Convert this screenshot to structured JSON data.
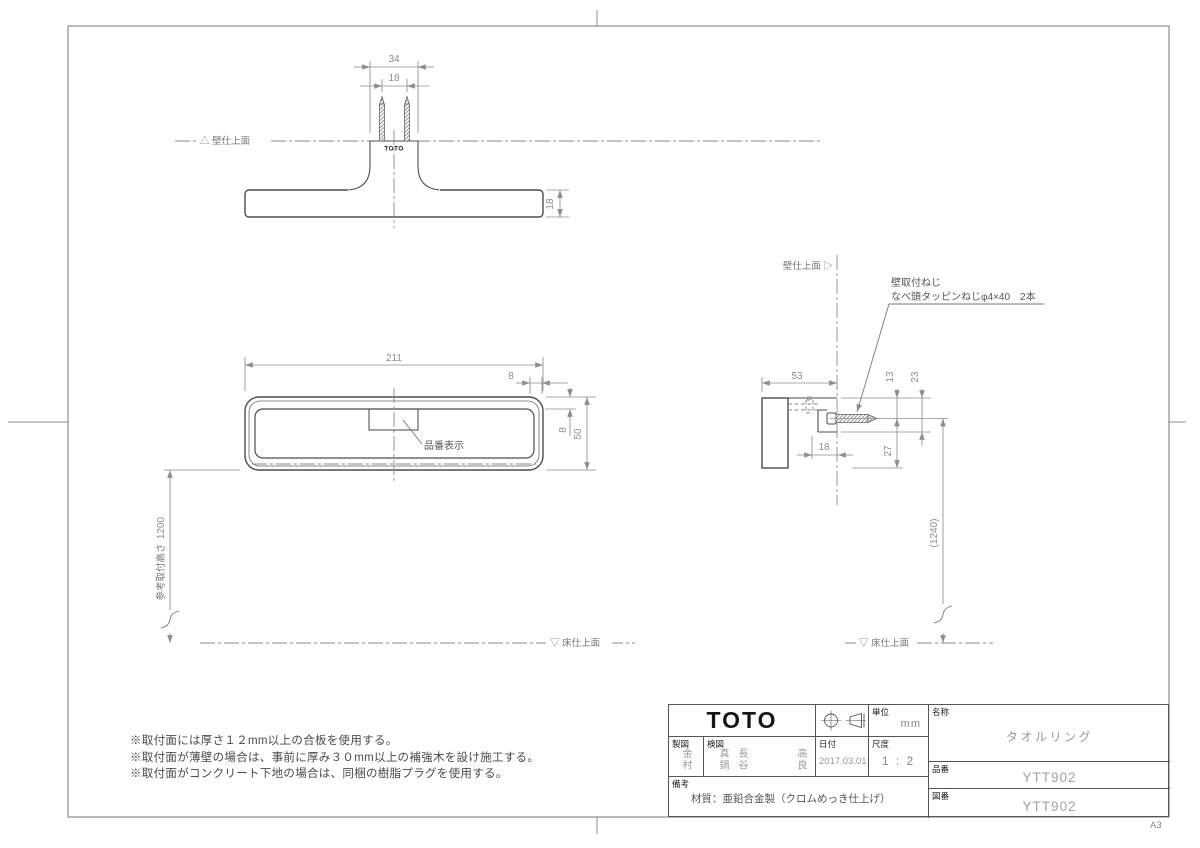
{
  "sheet": {
    "size": "A3"
  },
  "brand": {
    "logo": "TOTO",
    "part_logo": "TOTO"
  },
  "top_view": {
    "dim_mount_width": "34",
    "dim_screw_pitch": "18",
    "dim_bar_thickness": "18",
    "wall_line_label": "△ 壁仕上面"
  },
  "front_view": {
    "dim_overall_width": "211",
    "dim_rim_width": "8",
    "dim_rim_height": "8",
    "dim_overall_height": "50",
    "dim_mounting_height": "1200",
    "mounting_height_label": "参考取付高さ",
    "part_number_label": "品番表示",
    "floor_line_label": "▽ 床仕上面"
  },
  "side_view": {
    "wall_line_label": "壁仕上面 ▷",
    "screw_note_line1": "壁取付ねじ",
    "screw_note_line2": "なべ頭タッピンねじφ4×40　2本",
    "dim_depth": "53",
    "dim_screw_offset": "13",
    "dim_bracket_depth": "23",
    "dim_step": "18",
    "dim_lower": "27",
    "dim_ref_height": "(1240)",
    "floor_line_label": "▽ 床仕上面"
  },
  "notes": {
    "lines": [
      "※取付面には厚さ１２mm以上の合板を使用する。",
      "※取付面が薄壁の場合は、事前に厚み３０mm以上の補強木を設け施工する。",
      "※取付面がコンクリート下地の場合は、同梱の樹脂プラグを使用する。"
    ]
  },
  "title_block": {
    "drafter_label": "製図",
    "drafter": "金村",
    "checker_label": "検図",
    "checkers": [
      "真鍋",
      "長谷",
      "高良"
    ],
    "date_label": "日付",
    "date": "2017.03.01",
    "scale_label": "尺度",
    "scale": "1 : 2",
    "unit_label": "単位",
    "unit": "mm",
    "remarks_label": "備考",
    "remarks": "材質：亜鉛合金製（クロムめっき仕上げ）",
    "name_label": "名称",
    "name": "タオルリング",
    "part_no_label": "品番",
    "part_no": "YTT902",
    "dwg_no_label": "図番",
    "dwg_no": "YTT902"
  }
}
